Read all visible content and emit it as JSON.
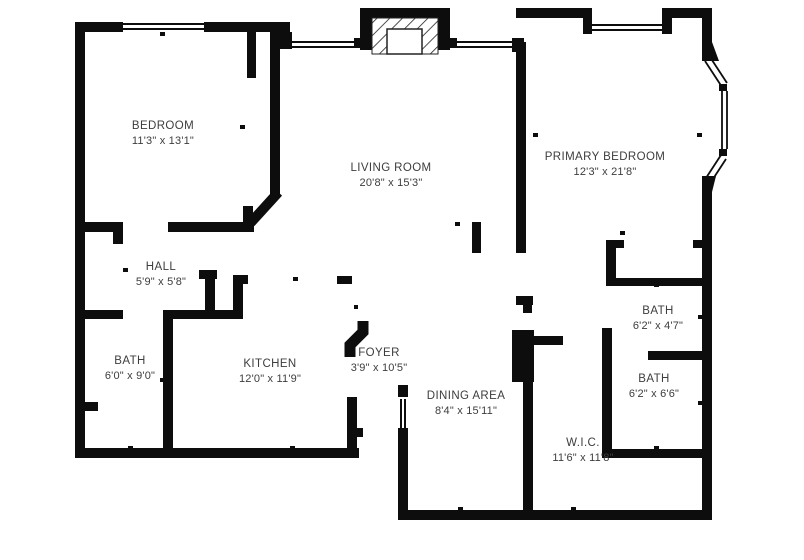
{
  "title": "Apartment floor plan",
  "colors": {
    "wall": "#0d0d0d",
    "text": "#3d3d3d",
    "background": "#ffffff"
  },
  "rooms": [
    {
      "id": "bedroom",
      "name": "BEDROOM",
      "dims": "11'3\" x 13'1\""
    },
    {
      "id": "living-room",
      "name": "LIVING ROOM",
      "dims": "20'8\" x 15'3\""
    },
    {
      "id": "primary-bedroom",
      "name": "PRIMARY BEDROOM",
      "dims": "12'3\" x 21'8\""
    },
    {
      "id": "hall",
      "name": "HALL",
      "dims": "5'9\" x 5'8\""
    },
    {
      "id": "bath-left",
      "name": "BATH",
      "dims": "6'0\" x 9'0\""
    },
    {
      "id": "kitchen",
      "name": "KITCHEN",
      "dims": "12'0\" x 11'9\""
    },
    {
      "id": "foyer",
      "name": "FOYER",
      "dims": "3'9\" x 10'5\""
    },
    {
      "id": "dining-area",
      "name": "DINING AREA",
      "dims": "8'4\" x 15'11\""
    },
    {
      "id": "bath-upper",
      "name": "BATH",
      "dims": "6'2\" x 4'7\""
    },
    {
      "id": "bath-lower",
      "name": "BATH",
      "dims": "6'2\" x 6'6\""
    },
    {
      "id": "walk-in-closet",
      "name": "W.I.C.",
      "dims": "11'6\" x 11'8\""
    }
  ]
}
